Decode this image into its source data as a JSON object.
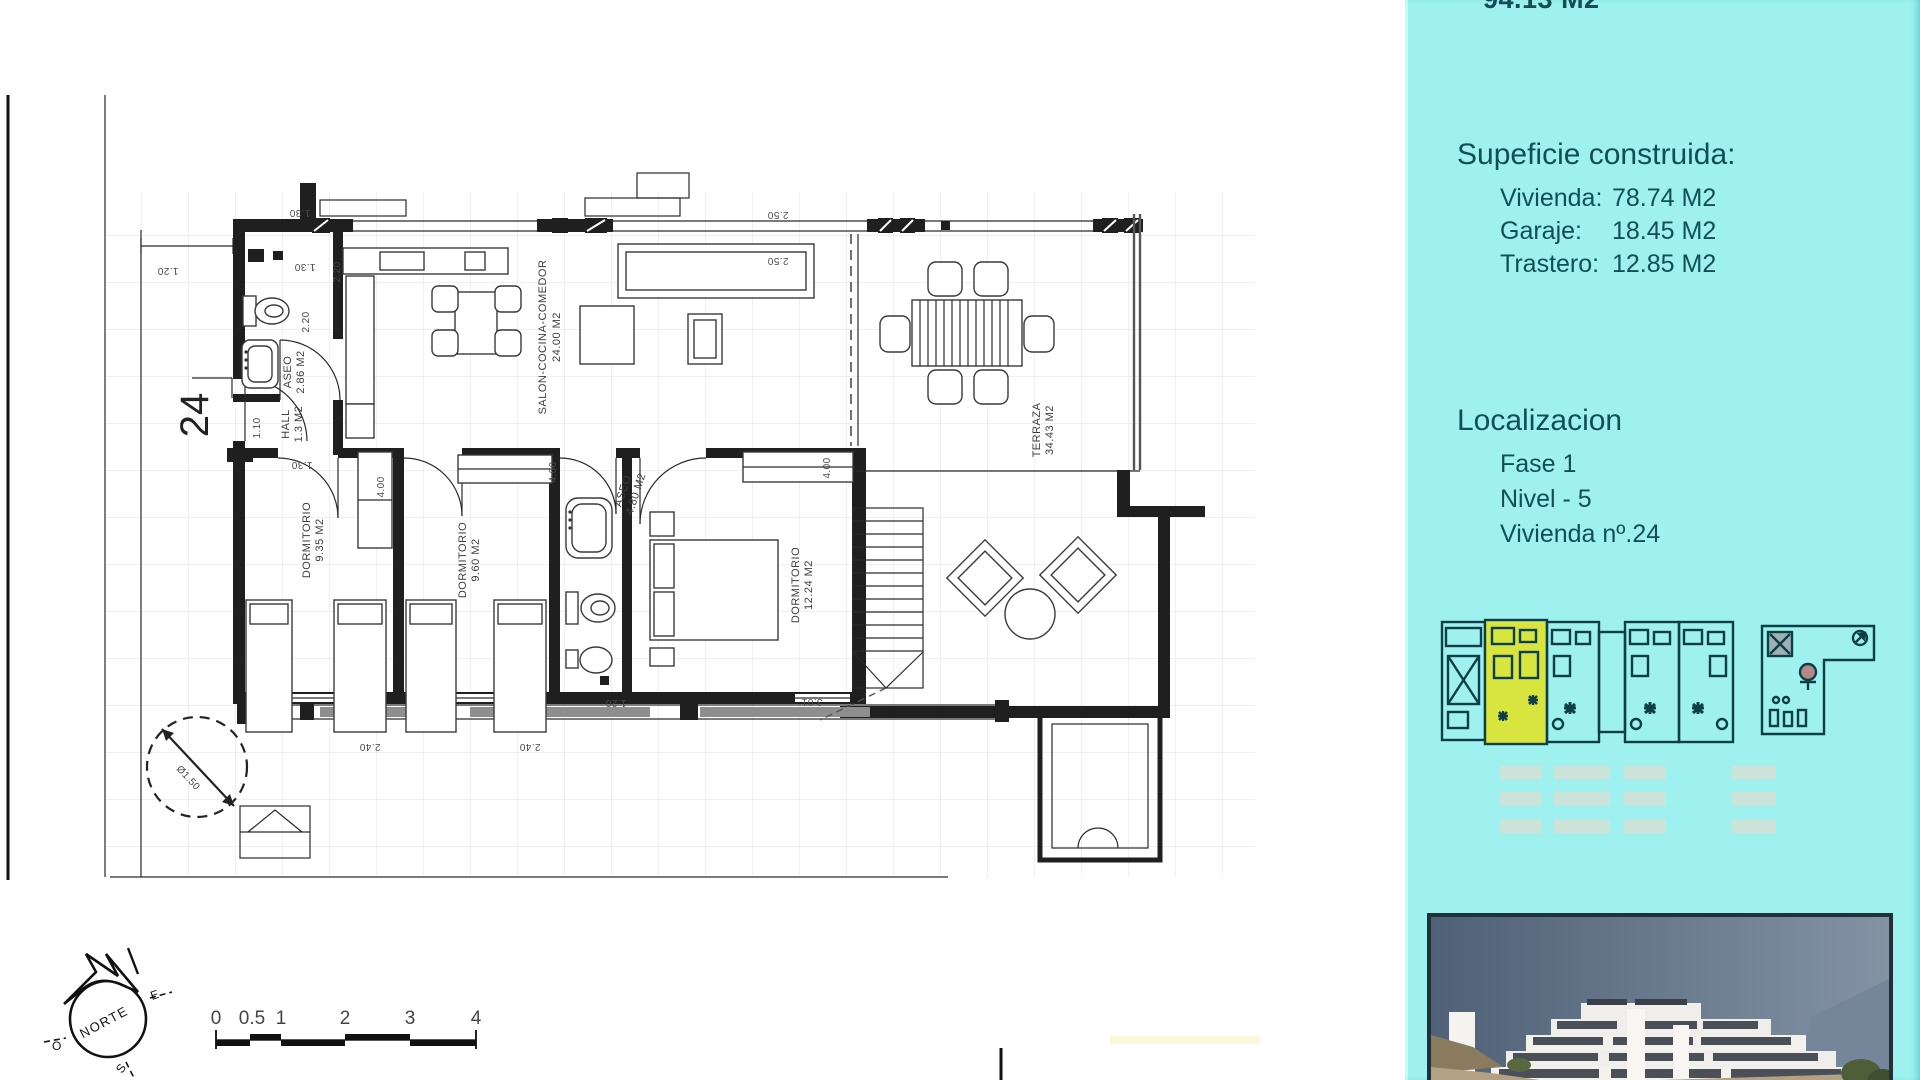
{
  "sidebar": {
    "panel_color": "#9EF1EE",
    "text_color": "#124E58",
    "top_clipped_text": "94.13 M2",
    "surface": {
      "heading": "Supeficie construida:",
      "rows": [
        {
          "label": "Vivienda:",
          "value": "78.74 M2"
        },
        {
          "label": "Garaje:",
          "value": "18.45 M2"
        },
        {
          "label": "Trastero:",
          "value": "12.85 M2"
        }
      ]
    },
    "location": {
      "heading": "Localizacion",
      "rows": [
        {
          "label": "Fase 1"
        },
        {
          "label": "Nivel - 5"
        },
        {
          "label": "Vivienda nº.24"
        }
      ]
    },
    "site_plan": {
      "highlight_color": "#D8E53E",
      "line_color": "#0E3F46",
      "highlighted_unit": "24"
    }
  },
  "floor_plan": {
    "unit_number": "24",
    "rooms": {
      "aseo1": {
        "name": "ASEO",
        "area": "2.86 M2"
      },
      "hall": {
        "name": "HALL",
        "area": "1.3 M2"
      },
      "salon": {
        "name": "SALON-COCINA-COMEDOR",
        "area": "24.00 M2"
      },
      "dorm1": {
        "name": "DORMITORIO",
        "area": "9.35 M2"
      },
      "dorm2": {
        "name": "DORMITORIO",
        "area": "9.60 M2"
      },
      "aseo2": {
        "name": "ASEO",
        "area": "4.80 M2"
      },
      "dorm3": {
        "name": "DORMITORIO",
        "area": "12.24 M2"
      },
      "terraza": {
        "name": "TERRAZA",
        "area": "34.43 M2"
      }
    },
    "dims": {
      "d1_20": "1.20",
      "d1_30": "1.30",
      "d2_20": "2.20",
      "d1_10": "1.10",
      "d2_50": "2.50",
      "d4_00": "4.00",
      "d2_40": "2.40",
      "d3_01": "3.01",
      "d1_50": "Ø1.50"
    },
    "compass": {
      "label": "NORTE",
      "east": "E",
      "west": "O",
      "south": "S"
    },
    "scale_bar": {
      "ticks": [
        "0",
        "0.5",
        "1",
        "2",
        "3",
        "4"
      ]
    }
  }
}
